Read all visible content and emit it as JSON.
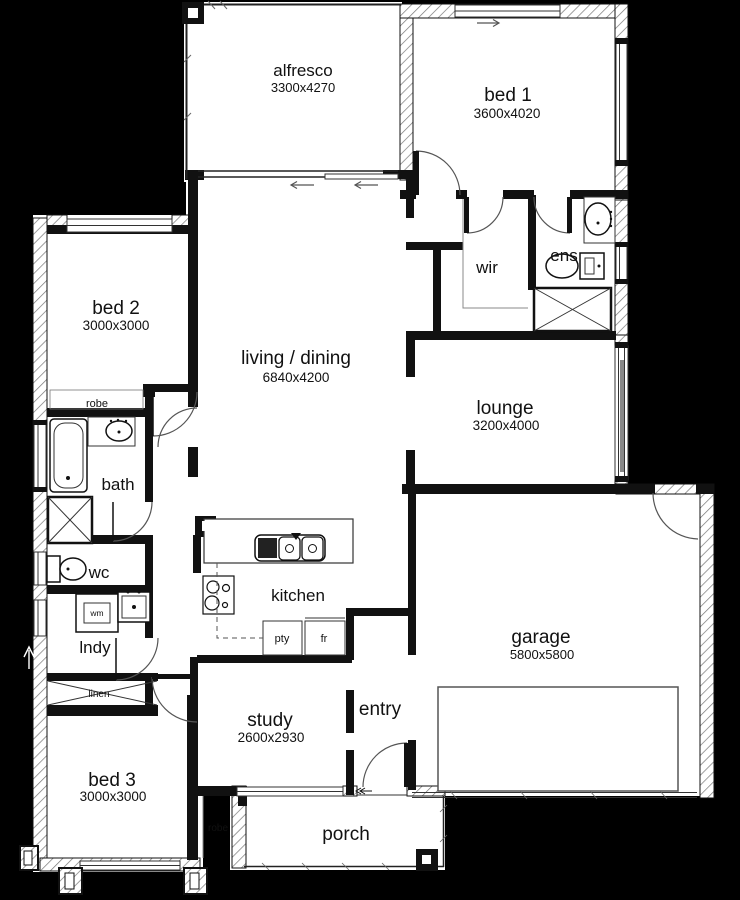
{
  "colors": {
    "background": "#000000",
    "floor": "#ffffff",
    "wall": "#111111",
    "hatch_line": "#777777",
    "thin_line": "#333333"
  },
  "rooms": {
    "alfresco": {
      "label": "alfresco",
      "dims": "3300x4270"
    },
    "bed1": {
      "label": "bed 1",
      "dims": "3600x4020"
    },
    "wir": {
      "label": "wir"
    },
    "ens": {
      "label": "ens"
    },
    "bed2": {
      "label": "bed 2",
      "dims": "3000x3000"
    },
    "living_dining": {
      "label": "living / dining",
      "dims": "6840x4200"
    },
    "lounge": {
      "label": "lounge",
      "dims": "3200x4000"
    },
    "robe_bed2": {
      "label": "robe"
    },
    "bath": {
      "label": "bath"
    },
    "wc": {
      "label": "wc"
    },
    "laundry": {
      "label": "lndy"
    },
    "washing_machine": {
      "label": "wm"
    },
    "linen": {
      "label": "linen"
    },
    "kitchen": {
      "label": "kitchen"
    },
    "pantry": {
      "label": "pty"
    },
    "fridge": {
      "label": "fr"
    },
    "study": {
      "label": "study",
      "dims": "2600x2930"
    },
    "entry": {
      "label": "entry"
    },
    "garage": {
      "label": "garage",
      "dims": "5800x5800"
    },
    "bed3": {
      "label": "bed 3",
      "dims": "3000x3000"
    },
    "robe_bed3": {
      "label": "robe"
    },
    "porch": {
      "label": "porch"
    }
  }
}
